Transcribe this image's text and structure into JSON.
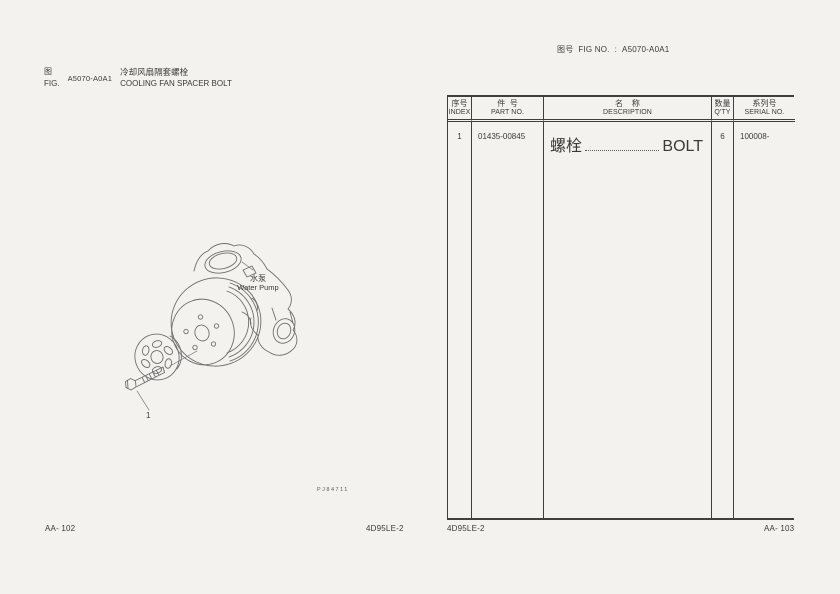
{
  "header": {
    "fig_no_label_cn": "图号",
    "fig_no_label_en": "FIG NO.",
    "fig_no_separator": ":",
    "fig_no_value": "A5070-A0A1"
  },
  "title_block": {
    "label_cn": "图",
    "label_en": "FIG.",
    "fig_code": "A5070-A0A1",
    "title_cn": "冷却风扇隔套螺栓",
    "title_en": "COOLING FAN SPACER BOLT"
  },
  "drawing": {
    "part_label_cn": "水泵",
    "part_label_en": "Water Pump",
    "callout_1": "1",
    "drawing_no": "PJ84711"
  },
  "table": {
    "headers": [
      {
        "cn": "序号",
        "en": "INDEX"
      },
      {
        "cn": "件  号",
        "en": "PART NO."
      },
      {
        "cn": "名    称",
        "en": "DESCRIPTION"
      },
      {
        "cn": "数量",
        "en": "Q'TY"
      },
      {
        "cn": "系列号",
        "en": "SERIAL NO."
      }
    ],
    "rows": [
      {
        "index": "1",
        "part_no": "01435-00845",
        "description_cn": "螺栓",
        "description_en": "BOLT",
        "qty": "6",
        "serial_no": "100008-"
      }
    ]
  },
  "footer": {
    "page_left": "AA- 102",
    "model_center": "4D95LE-2",
    "model_table": "4D95LE-2",
    "page_right": "AA- 103"
  }
}
